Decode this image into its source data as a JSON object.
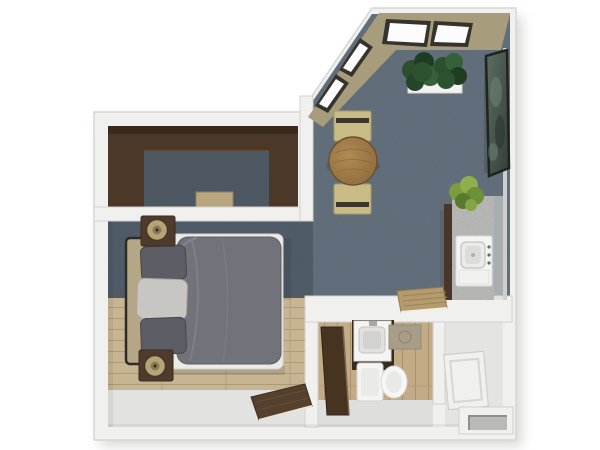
{
  "scene": {
    "type": "3d-floor-plan",
    "view": "top-down studio apartment rendering",
    "rooms": [
      "living-dining-area",
      "sleeping-area",
      "walk-in-closet",
      "bathroom",
      "kitchenette",
      "entry-hall"
    ]
  },
  "palette": {
    "background": "#ffffff",
    "wall": "#f0f0ee",
    "wall_edge": "#d6d6d4",
    "wall_inner_tan": "#a79d7d",
    "carpet": "#66727e",
    "carpet_noise": "#1a222c",
    "wood_floor": "#c7b492",
    "bath_wood": "#c2ab85",
    "hall_floor": "#e2e2e0",
    "entry_floor": "#e4e4e2",
    "closet_wood": "#4c3829",
    "door_wood": "#54402d",
    "bath_door_wood": "#463320",
    "bed_duvet": "#72727a",
    "pillow_dark": "#5d5d65",
    "pillow_light": "#c8c6c3",
    "sheet": "#eceae6",
    "headboard": "#b5a685",
    "lamp": "#b7a374",
    "table_wood": "#a5804e",
    "bench": "#c9bb85",
    "granite": "#bcbcba",
    "fixture_white": "#f4f4f2",
    "plant_dark_green": "#2c4f2e",
    "plant_light_green": "#7c9c3e",
    "art_sage": "#4e5f55",
    "window_frame": "#35332c",
    "glass": "#fcfcfc",
    "wall_mat_tan": "#b59a6d",
    "bath_mat": "#a79d89",
    "closet_box_tan": "#b7a67e",
    "threshold_slot": "#b9b9b7"
  }
}
